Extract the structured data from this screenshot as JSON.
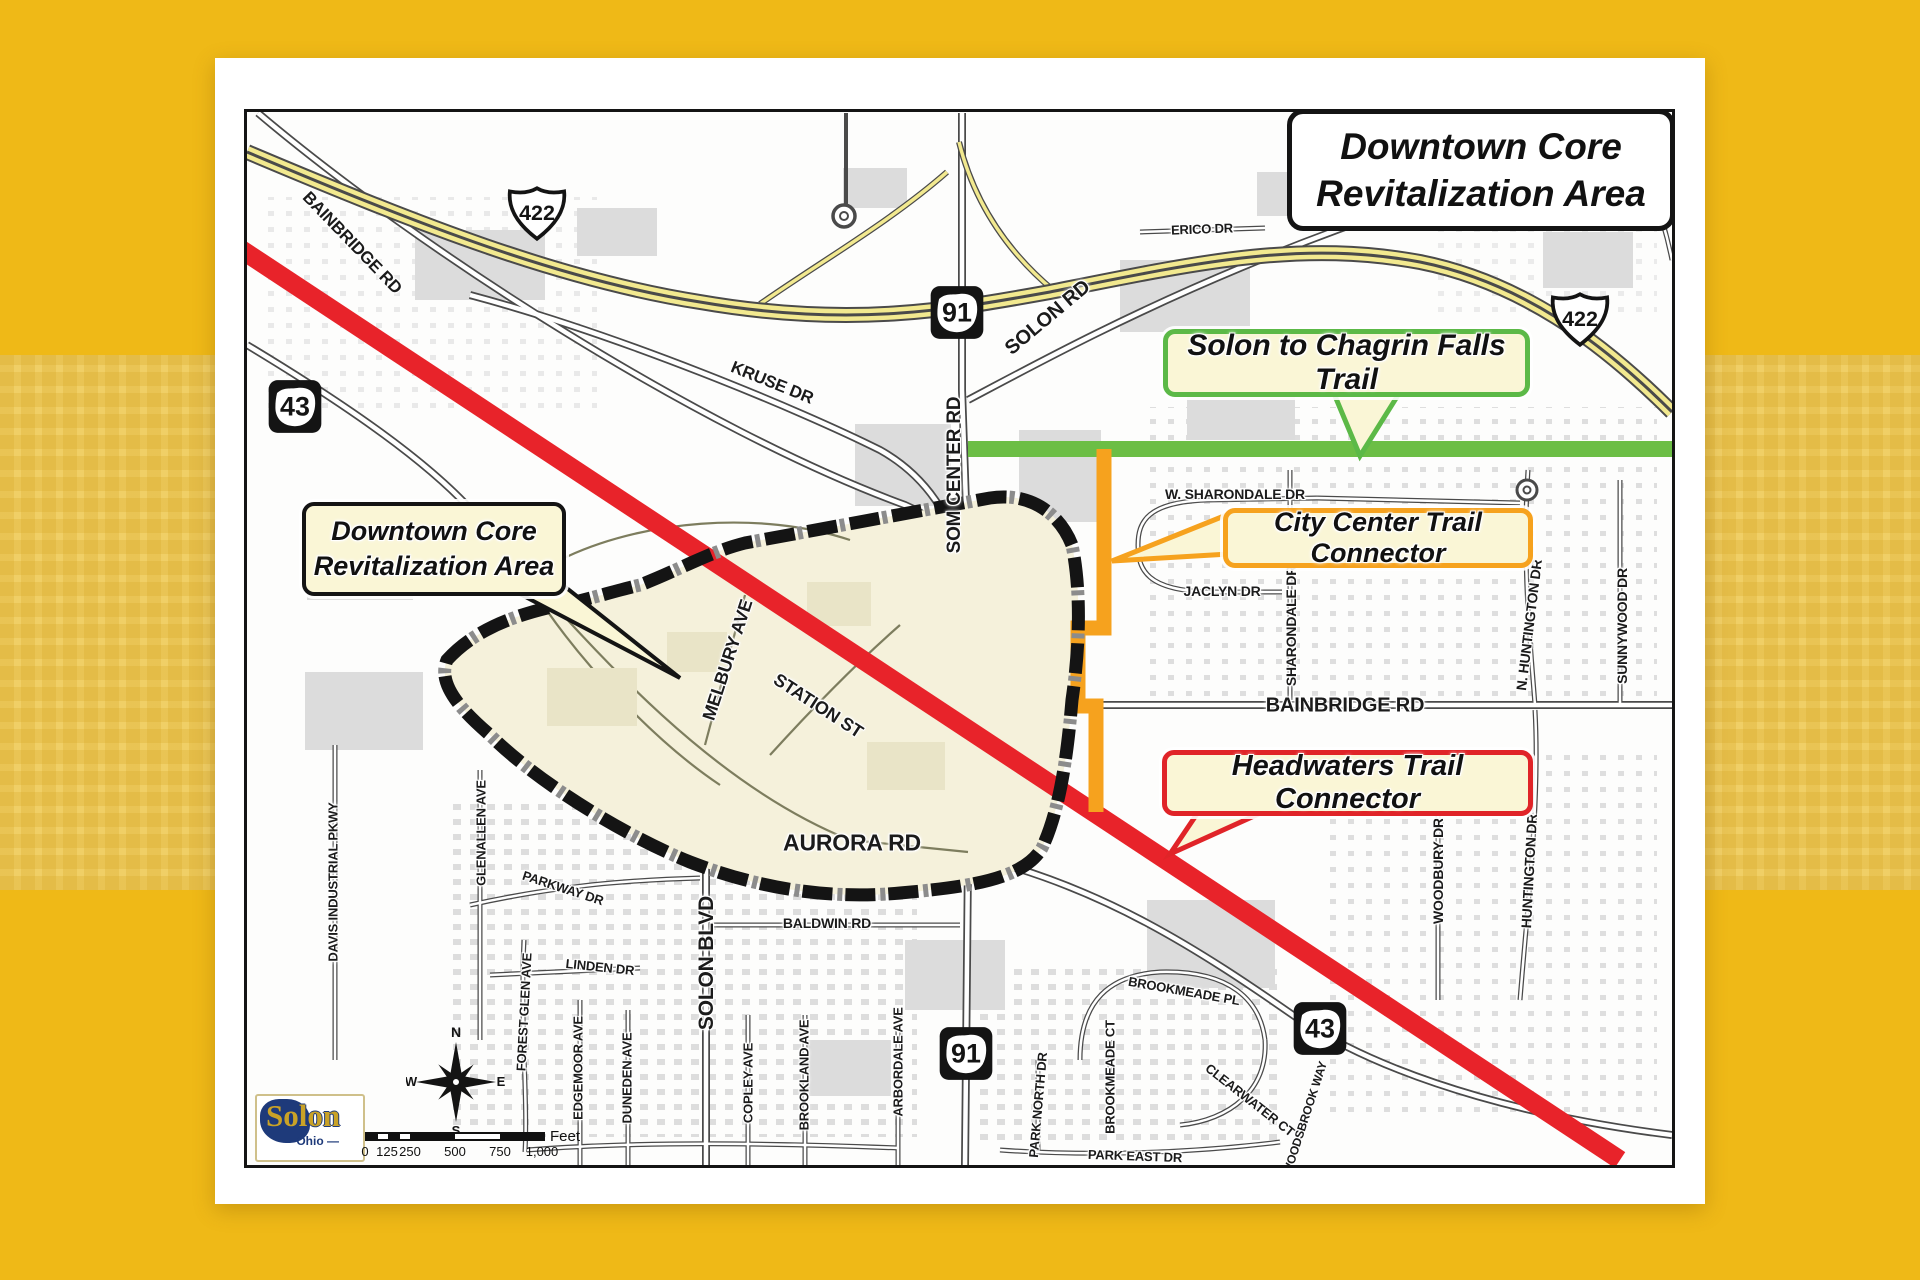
{
  "title": {
    "line1": "Downtown Core",
    "line2": "Revitalization Area"
  },
  "callouts": {
    "downtown": {
      "line1": "Downtown Core",
      "line2": "Revitalization Area"
    },
    "solon_chagrin": {
      "label": "Solon to Chagrin Falls Trail"
    },
    "city_center": {
      "label": "City Center Trail Connector"
    },
    "headwaters": {
      "label": "Headwaters Trail Connector"
    }
  },
  "colors": {
    "background_gold": "#EFB917",
    "background_band": "#F0CF66",
    "trail_green": "#6CBE45",
    "trail_orange": "#F6A21E",
    "trail_red": "#E8232A",
    "area_fill": "#F5F1DB",
    "callout_fill": "#FAF6D6"
  },
  "logo": {
    "city": "Solon",
    "state": "— Ohio —"
  },
  "compass": {
    "n": "N",
    "e": "E",
    "s": "S",
    "w": "W"
  },
  "scalebar": {
    "ticks": [
      "0",
      "125",
      "250",
      "500",
      "750",
      "1,000"
    ],
    "unit": "Feet"
  },
  "shields": [
    {
      "system": "US",
      "num": "422",
      "x": 290,
      "y": 104
    },
    {
      "system": "US",
      "num": "422",
      "x": 1333,
      "y": 210
    },
    {
      "system": "OH",
      "num": "91",
      "x": 710,
      "y": 203
    },
    {
      "system": "OH",
      "num": "43",
      "x": 48,
      "y": 297
    },
    {
      "system": "OH",
      "num": "91",
      "x": 719,
      "y": 944
    },
    {
      "system": "OH",
      "num": "43",
      "x": 1073,
      "y": 919
    }
  ],
  "streets": [
    {
      "name": "BAINBRIDGE RD",
      "x": 105,
      "y": 131,
      "rot": 46,
      "size": 17
    },
    {
      "name": "KRUSE DR",
      "x": 525,
      "y": 271,
      "rot": 22,
      "size": 17
    },
    {
      "name": "SOLON RD",
      "x": 801,
      "y": 206,
      "rot": -40,
      "size": 20
    },
    {
      "name": "SOM CENTER RD",
      "x": 708,
      "y": 363,
      "rot": -90,
      "size": 19
    },
    {
      "name": "ERICO DR",
      "x": 955,
      "y": 117,
      "rot": -2,
      "size": 13
    },
    {
      "name": "W. SHARONDALE DR",
      "x": 988,
      "y": 382,
      "rot": 0,
      "size": 14
    },
    {
      "name": "JACLYN DR",
      "x": 975,
      "y": 479,
      "rot": 0,
      "size": 14
    },
    {
      "name": "SHARONDALE DR",
      "x": 1044,
      "y": 514,
      "rot": -90,
      "size": 14
    },
    {
      "name": "N. HUNTINGTON DR",
      "x": 1282,
      "y": 513,
      "rot": -83,
      "size": 14
    },
    {
      "name": "SUNNYWOOD DR",
      "x": 1375,
      "y": 514,
      "rot": -90,
      "size": 14
    },
    {
      "name": "BAINBRIDGE RD",
      "x": 1098,
      "y": 594,
      "rot": 0,
      "size": 20
    },
    {
      "name": "MELBURY AVE",
      "x": 481,
      "y": 548,
      "rot": -72,
      "size": 18
    },
    {
      "name": "STATION ST",
      "x": 571,
      "y": 594,
      "rot": 33,
      "size": 18
    },
    {
      "name": "AURORA RD",
      "x": 605,
      "y": 731,
      "rot": 0,
      "size": 23
    },
    {
      "name": "BALDWIN RD",
      "x": 580,
      "y": 811,
      "rot": 0,
      "size": 14
    },
    {
      "name": "SOLON BLVD",
      "x": 460,
      "y": 851,
      "rot": -90,
      "size": 21
    },
    {
      "name": "GLENALLEN AVE",
      "x": 234,
      "y": 721,
      "rot": -90,
      "size": 13
    },
    {
      "name": "PARKWAY DR",
      "x": 316,
      "y": 776,
      "rot": 18,
      "size": 13
    },
    {
      "name": "LINDEN DR",
      "x": 353,
      "y": 855,
      "rot": 6,
      "size": 13
    },
    {
      "name": "FOREST GLEN AVE",
      "x": 277,
      "y": 900,
      "rot": -87,
      "size": 13
    },
    {
      "name": "EDGEMOOR AVE",
      "x": 331,
      "y": 956,
      "rot": -90,
      "size": 13
    },
    {
      "name": "DUNEDEN AVE",
      "x": 380,
      "y": 966,
      "rot": -90,
      "size": 13
    },
    {
      "name": "COPLEY AVE",
      "x": 501,
      "y": 971,
      "rot": -90,
      "size": 13
    },
    {
      "name": "BROOKLAND AVE",
      "x": 557,
      "y": 963,
      "rot": -90,
      "size": 13
    },
    {
      "name": "ARBORDALE AVE",
      "x": 651,
      "y": 950,
      "rot": -90,
      "size": 13
    },
    {
      "name": "DAVIS INDUSTRIAL PKWY",
      "x": 86,
      "y": 770,
      "rot": -90,
      "size": 13
    },
    {
      "name": "PARK NORTH DR",
      "x": 791,
      "y": 993,
      "rot": -85,
      "size": 13
    },
    {
      "name": "PARK EAST DR",
      "x": 888,
      "y": 1044,
      "rot": 2,
      "size": 13
    },
    {
      "name": "BROOKMEADE PL",
      "x": 937,
      "y": 879,
      "rot": 10,
      "size": 13
    },
    {
      "name": "BROOKMEADE CT",
      "x": 863,
      "y": 965,
      "rot": -90,
      "size": 13
    },
    {
      "name": "CLEARWATER CT",
      "x": 1003,
      "y": 988,
      "rot": 38,
      "size": 13
    },
    {
      "name": "WOODSBROOK WAY",
      "x": 1058,
      "y": 1006,
      "rot": -72,
      "size": 12
    },
    {
      "name": "WOODBURY DR",
      "x": 1191,
      "y": 759,
      "rot": -90,
      "size": 14
    },
    {
      "name": "HUNTINGTON DR",
      "x": 1282,
      "y": 759,
      "rot": -87,
      "size": 14
    }
  ]
}
